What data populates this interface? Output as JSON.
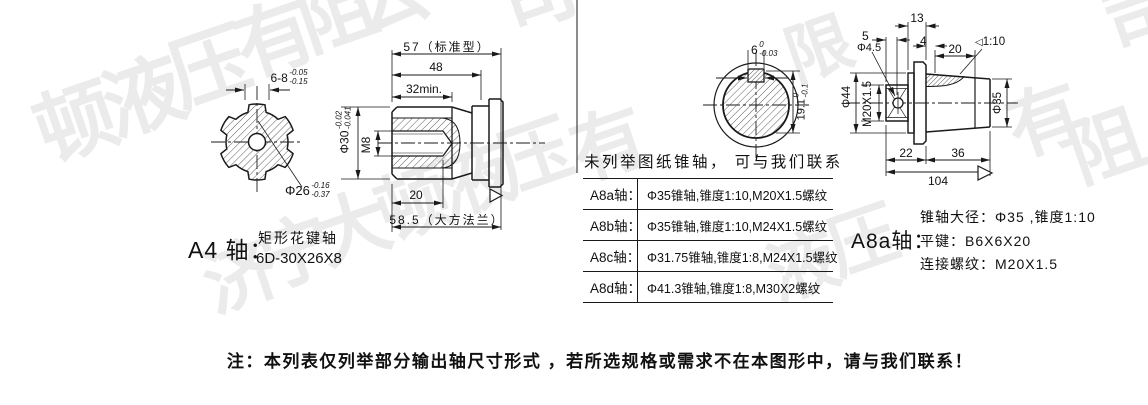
{
  "meta": {
    "bg": "#ffffff",
    "line_color": "#1a1a1a",
    "watermark_color": "#ebebeb"
  },
  "watermark": {
    "glyphs": [
      {
        "ch": "顿",
        "x": 36,
        "y": 84,
        "s": 80
      },
      {
        "ch": "液",
        "x": 104,
        "y": 58,
        "s": 80
      },
      {
        "ch": "压",
        "x": 170,
        "y": 28,
        "s": 80
      },
      {
        "ch": "有",
        "x": 236,
        "y": 0,
        "s": 78
      },
      {
        "ch": "阻",
        "x": 298,
        "y": -26,
        "s": 78
      },
      {
        "ch": "公",
        "x": 352,
        "y": -40,
        "s": 76
      },
      {
        "ch": "司",
        "x": 500,
        "y": -42,
        "s": 76
      },
      {
        "ch": "济",
        "x": 204,
        "y": 240,
        "s": 74
      },
      {
        "ch": "宁",
        "x": 260,
        "y": 216,
        "s": 74
      },
      {
        "ch": "大",
        "x": 316,
        "y": 192,
        "s": 74
      },
      {
        "ch": "顿",
        "x": 377,
        "y": 168,
        "s": 74
      },
      {
        "ch": "液",
        "x": 438,
        "y": 144,
        "s": 74
      },
      {
        "ch": "压",
        "x": 498,
        "y": 120,
        "s": 74
      },
      {
        "ch": "有",
        "x": 572,
        "y": 108,
        "s": 74
      },
      {
        "ch": "限",
        "x": 786,
        "y": 16,
        "s": 66
      },
      {
        "ch": "液",
        "x": 768,
        "y": 232,
        "s": 70
      },
      {
        "ch": "压",
        "x": 828,
        "y": 206,
        "s": 70
      },
      {
        "ch": "有",
        "x": 1008,
        "y": 84,
        "s": 74
      },
      {
        "ch": "阻",
        "x": 1070,
        "y": 110,
        "s": 74
      },
      {
        "ch": "司",
        "x": 1104,
        "y": -20,
        "s": 74
      }
    ]
  },
  "left_shaft": {
    "name_label": "A4 轴：",
    "type_line1": "矩形花键轴",
    "type_line2": "6D-30X26X8",
    "front_view": {
      "spline_width": {
        "main": "6-8",
        "upper": "-0.05",
        "lower": "-0.15"
      },
      "minor_dia": {
        "main": "Φ26",
        "upper": "-0.16",
        "lower": "-0.37"
      }
    },
    "side_view": {
      "len_total": "57（标准型）",
      "len_48": "48",
      "len_spline": "32min.",
      "thread": "M8",
      "major_dia": {
        "main": "Φ30",
        "upper": "-0.02",
        "lower": "-0.041"
      },
      "thread_depth": "20",
      "len_flange": "58.5（大方法兰）"
    }
  },
  "middle_section": {
    "front_view": {
      "key_width": {
        "main": "6",
        "upper": "0",
        "lower": "-0.03"
      },
      "key_depth": {
        "main": "19.1",
        "upper": "0",
        "lower": "-0.1"
      }
    },
    "note": "未列举图纸锥轴， 可与我们联系",
    "table": {
      "rows": [
        {
          "label": "A8a轴：",
          "desc": "Φ35锥轴,锥度1:10,M20X1.5螺纹"
        },
        {
          "label": "A8b轴：",
          "desc": "Φ35锥轴,锥度1:10,M24X1.5螺纹"
        },
        {
          "label": "A8c轴：",
          "desc": "Φ31.75锥轴,锥度1:8,M24X1.5螺纹"
        },
        {
          "label": "A8d轴：",
          "desc": "Φ41.3锥轴,锥度1:8,M30X2螺纹"
        }
      ]
    }
  },
  "right_shaft": {
    "dims": {
      "d13": "13",
      "d5": "5",
      "d4": "4",
      "hole": "Φ4.5",
      "key_len": "20",
      "taper": "1:10",
      "taper_icon": "◁",
      "flange_dia": "Φ44",
      "thread": "M20X1.5",
      "shaft_dia": "Φ35",
      "d22": "22",
      "d36": "36",
      "d104": "104"
    },
    "name_label": "A8a轴：",
    "spec_taper": "锥轴大径：Φ35 ,锥度1:10",
    "spec_key": "平键：B6X6X20",
    "spec_thread": "连接螺纹：M20X1.5"
  },
  "footer": {
    "note": "注：本列表仅列举部分输出轴尺寸形式 ，若所选规格或需求不在本图形中，请与我们联系！"
  }
}
